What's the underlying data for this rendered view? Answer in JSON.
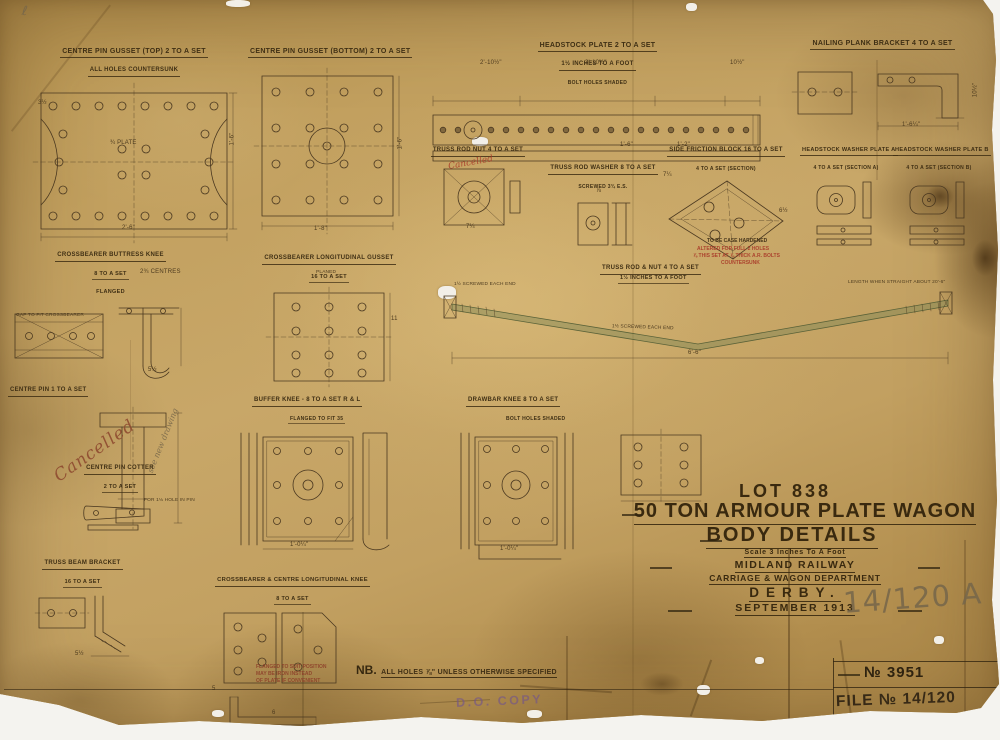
{
  "sheet": {
    "corner_mark": "ℓ",
    "note_prefix": "NB.",
    "note_text": "ALL HOLES ⅞\" UNLESS OTHERWISE SPECIFIED"
  },
  "title_block": {
    "lot": "LOT 838",
    "main_title": "50 TON ARMOUR PLATE WAGON",
    "subtitle": "BODY DETAILS",
    "scale": "Scale 3 Inches To A Foot",
    "railway": "MIDLAND RAILWAY",
    "department": "CARRIAGE & WAGON DEPARTMENT",
    "place": "DERBY.",
    "date": "SEPTEMBER 1913",
    "pencil_reference": "14/120 A"
  },
  "stamps": {
    "do_copy": "D.O. COPY",
    "drawing_number": "№ 3951",
    "file_number": "FILE № 14/120"
  },
  "handwriting": {
    "cancelled": "Cancelled",
    "cancelled_note": "see new drawing"
  },
  "drawings": {
    "centre_pin_gusset_top": {
      "title": "CENTRE PIN GUSSET (TOP) 2 TO A SET",
      "subtitle": "ALL HOLES COUNTERSUNK",
      "dims": [
        "3½",
        "¾ PLATE",
        "1'-6\"",
        "2'-6\""
      ]
    },
    "centre_pin_gusset_bottom": {
      "title": "CENTRE PIN GUSSET (BOTTOM) 2 TO A SET",
      "dims": [
        "1'-6\"",
        "1'-8\""
      ]
    },
    "headstock_plate": {
      "title": "HEADSTOCK PLATE 2 TO A SET",
      "scale_note": "1½ INCHES TO A FOOT",
      "shading_note": "BOLT HOLES SHADED",
      "dims": [
        "2'-10½\"",
        "3'-10½\"",
        "10½\"",
        "1'-6\"",
        "1'-2\""
      ]
    },
    "nailing_plank_bracket": {
      "title": "NAILING PLANK BRACKET 4 TO A SET",
      "dims": [
        "1'-6¼\"",
        "10½\""
      ]
    },
    "truss_rod_nut": {
      "title": "TRUSS ROD NUT 4 TO A SET",
      "dims": [
        "7¼"
      ]
    },
    "truss_rod_washer": {
      "title": "TRUSS ROD WASHER 8 TO A SET",
      "subtitle": "SCREWED 3¾ E.S.",
      "dims": [
        "⅞"
      ]
    },
    "side_friction_block": {
      "title": "SIDE FRICTION BLOCK 16 TO A SET",
      "subtitle": "4 TO A SET (SECTION)",
      "note": "TO BE CASE HARDENED",
      "red_note_lines": [
        "ALTERED FOR FULL 2 HOLES",
        "⅞ THIS SET AT ⅞ THICK A.R. BOLTS",
        "COUNTERSUNK"
      ],
      "dims": [
        "7¼",
        "6½"
      ]
    },
    "headstock_washer_plate_a": {
      "title": "HEADSTOCK WASHER PLATE A",
      "subtitle": "4 TO A SET (SECTION A)"
    },
    "headstock_washer_plate_b": {
      "title": "HEADSTOCK WASHER PLATE B",
      "subtitle": "4 TO A SET (SECTION B)"
    },
    "crossbearer_buttress_knee": {
      "title": "CROSSBEARER BUTTRESS KNEE",
      "qty": "8 TO A SET",
      "note": "FLANGED",
      "labels": [
        "2¾ CENTRES",
        "GAP TO FIT CROSSBEARER"
      ],
      "dims": [
        "5½"
      ]
    },
    "crossbearer_longitudinal_gusset": {
      "title": "CROSSBEARER LONGITUDINAL GUSSET",
      "qty": "16 TO A SET",
      "labels": [
        "PLANED"
      ],
      "dims": [
        "11"
      ]
    },
    "truss_rod_assembly": {
      "title": "TRUSS ROD & NUT 4 TO A SET",
      "scale_note": "1½ INCHES TO A FOOT",
      "labels": [
        "1½ SCREWED EACH END",
        "LENGTH WHEN STRAIGHT ABOUT 20'-6\"",
        "1½ SCREWED EACH END"
      ],
      "dims": [
        "6'-6\""
      ]
    },
    "centre_pin": {
      "title": "CENTRE PIN 1 TO A SET"
    },
    "centre_pin_cotter": {
      "title": "CENTRE PIN COTTER",
      "qty": "2 TO A SET",
      "label": "FOR 1⅛ HOLE IN PIN"
    },
    "buffer_knee": {
      "title": "BUFFER KNEE - 8 TO A SET  R & L",
      "note": "FLANGED TO FIT 35",
      "dims": [
        "1'-0¼\""
      ]
    },
    "drawbar_knee": {
      "title": "DRAWBAR KNEE 8 TO A SET",
      "note": "BOLT HOLES SHADED",
      "dims": [
        "1'-0¼\""
      ]
    },
    "truss_beam_bracket": {
      "title": "TRUSS BEAM BRACKET",
      "qty": "16 TO A SET",
      "dims": [
        "5½"
      ]
    },
    "crossbearer_centre_longitudinal_knee": {
      "title": "CROSSBEARER & CENTRE LONGITUDINAL KNEE",
      "qty": "8 TO A SET",
      "note_lines": [
        "FLANGED TO SUIT POSITION",
        "MAY BE IRON INSTEAD",
        "OF PLATE IF CONVENIENT"
      ],
      "dims": [
        "6",
        "5"
      ]
    }
  }
}
